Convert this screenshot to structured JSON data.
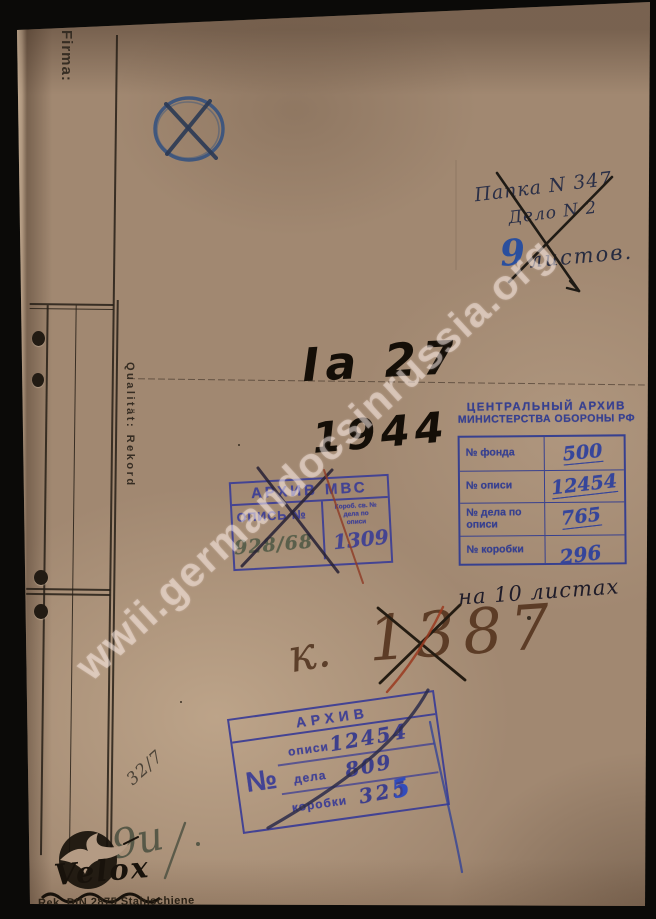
{
  "document": {
    "folder_print": {
      "firma_label": "Firma:",
      "quality_label": "Qualität: Rekord",
      "brand_name": "Velox",
      "brand_spec": "Rek. DIN 2875 Stahlschiene"
    },
    "handwriting": {
      "top_right_line1": "Папка N 347",
      "top_right_line2": "Дело N 2",
      "top_right_number": "9",
      "top_right_word": "листов.",
      "title_code": "Ia 27",
      "year": "1944",
      "sheets_note": "на 10 листах",
      "box_prefix": "к.",
      "box_number": "1387",
      "corner_note": "32/7",
      "bottom_pencil": "9u"
    },
    "stamp_mvs": {
      "title": "АРХИВ МВС",
      "opis_label": "ОПИСЬ №",
      "cell_line1": "Короб. св. №",
      "cell_line2": "дела по",
      "cell_line3": "описи",
      "opis_value": "928/68",
      "cell_value": "1309"
    },
    "stamp_camo": {
      "title_line1": "ЦЕНТРАЛЬНЫЙ АРХИВ",
      "title_line2": "МИНИСТЕРСТВА ОБОРОНЫ РФ",
      "rows": [
        {
          "label": "№ фонда",
          "value": "500"
        },
        {
          "label": "№ описи",
          "value": "12454"
        },
        {
          "label": "№ дела по описи",
          "value": "765"
        },
        {
          "label": "№ коробки",
          "value": "296"
        }
      ]
    },
    "stamp_archive2": {
      "title": "АРХИВ",
      "no_symbol": "№",
      "rows": [
        {
          "label": "описи",
          "value": "12454"
        },
        {
          "label": "дела",
          "value": "809"
        },
        {
          "label": "коробки",
          "value": "325"
        }
      ],
      "overwrite_digit": "5"
    },
    "watermark": "wwii.germandocsinrussia.org",
    "colors": {
      "paper": "#a18871",
      "scan_background": "#0b0a08",
      "stamp_violet": "#3c3e96",
      "ink_blue": "#2a4f9e",
      "marker_black": "#140e07",
      "pencil_brown": "#5c3c26",
      "red_pencil": "#9a3a20"
    }
  }
}
